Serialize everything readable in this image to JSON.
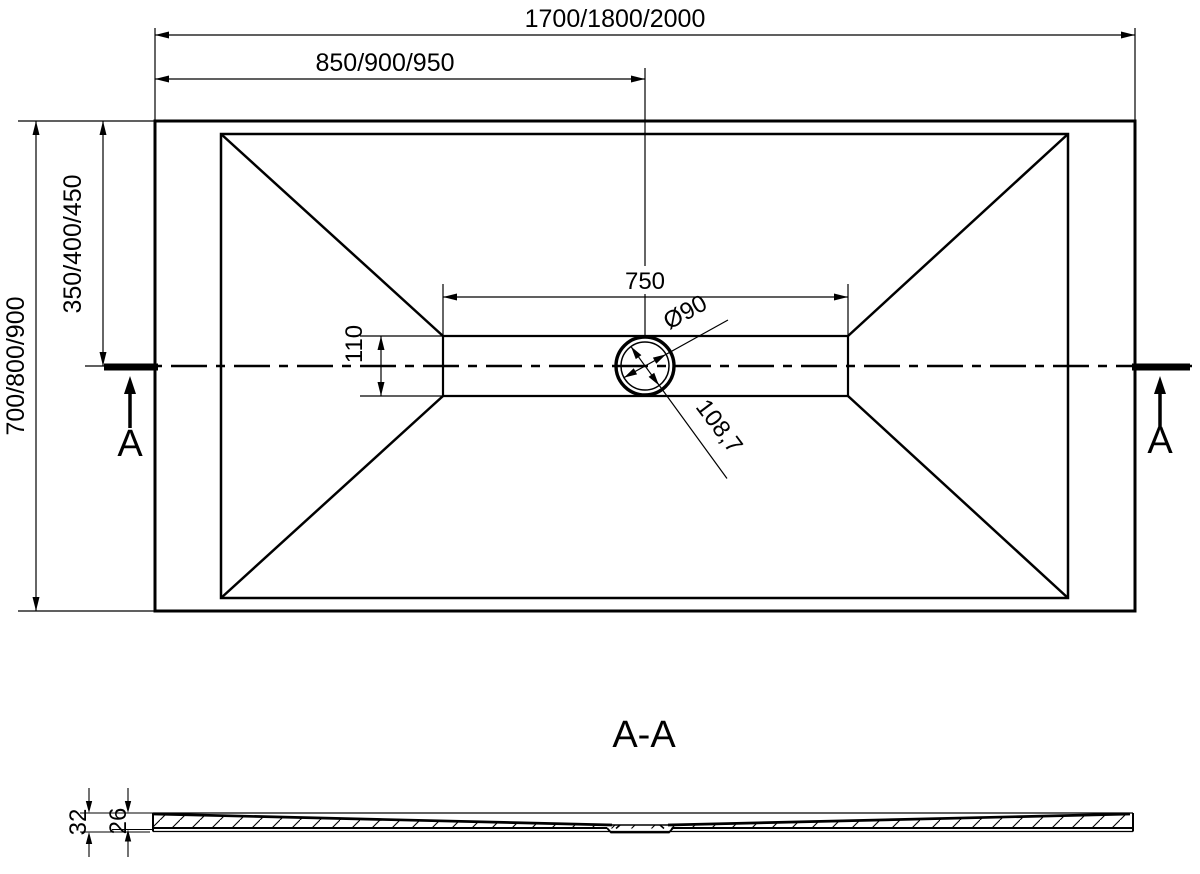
{
  "top_view": {
    "dimensions": {
      "overall_length": "1700/1800/2000",
      "length_to_drain_center": "850/900/950",
      "overall_width": "700/800/900",
      "width_to_drain_center": "350/400/450",
      "channel_length": "750",
      "channel_width": "110",
      "drain_diameter": "Ø90",
      "drain_diagonal": "108,7"
    },
    "section_markers": {
      "left": "A",
      "right": "A"
    }
  },
  "section_view": {
    "title": "A-A",
    "dimensions": {
      "overall_height": "32",
      "base_height": "26"
    }
  },
  "colors": {
    "line": "#000000",
    "background": "#ffffff"
  }
}
